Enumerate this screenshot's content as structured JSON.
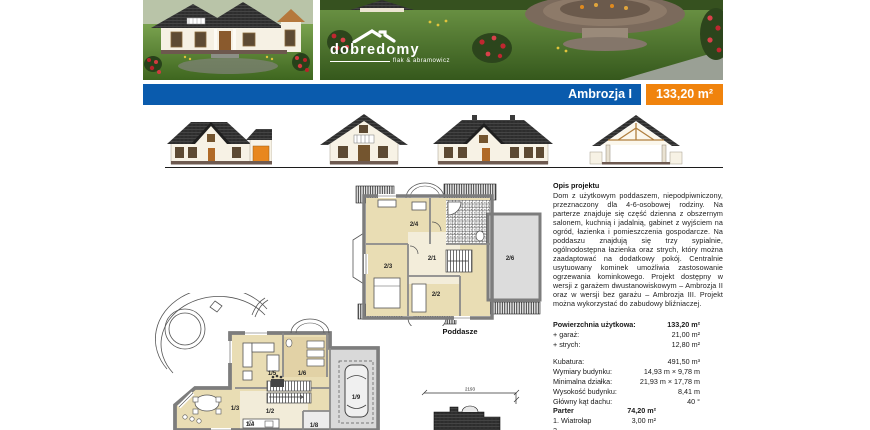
{
  "header": {
    "title": "Ambrozja I",
    "area_badge": "133,20 m²",
    "brand_name": "dobredomy",
    "brand_tagline": "flak & abramowicz"
  },
  "plans": {
    "attic": {
      "caption": "Poddasze",
      "rooms": [
        "2/1",
        "2/2",
        "2/3",
        "2/4",
        "2/6"
      ]
    },
    "ground": {
      "rooms": [
        "1/2",
        "1/3",
        "1/4",
        "1/5",
        "1/6",
        "1/8",
        "1/9"
      ]
    },
    "roof_outline": {
      "width_dimension": "2193"
    }
  },
  "description": {
    "heading": "Opis projektu",
    "body": "Dom z użytkowym poddaszem, niepodpiwniczony, przeznaczony dla 4-6-osobowej rodziny. Na parterze znajduje się część dzienna z obszernym salonem, kuchnią i jadalnią, gabinet z wyjściem na ogród, łazienka i pomieszczenia gospodarcze. Na poddaszu znajdują się trzy sypialnie, ogólnodostępna łazienka oraz strych, który można zaadaptować na dodatkowy pokój. Centralnie usytuowany kominek umożliwia zastosowanie ogrzewania kominkowego. Projekt dostępny w wersji z garażem dwustanowiskowym – Ambrozja II oraz w wersji bez garażu – Ambrozja III. Projekt można wykorzystać do zabudowy bliźniaczej."
  },
  "specs": {
    "main": [
      {
        "label": "Powierzchnia użytkowa:",
        "value": "133,20 m²"
      },
      {
        "label": "+ garaż:",
        "value": "21,00 m²"
      },
      {
        "label": "+ strych:",
        "value": "12,80 m²"
      }
    ],
    "details": [
      {
        "label": "Kubatura:",
        "value": "491,50 m³"
      },
      {
        "label": "Wymiary budynku:",
        "value": "14,93 m × 9,78 m"
      },
      {
        "label": "Minimalna działka:",
        "value": "21,93 m × 17,78 m"
      },
      {
        "label": "Wysokość budynku:",
        "value": "8,41 m"
      },
      {
        "label": "Główny kąt dachu:",
        "value": "40 °"
      }
    ],
    "floor": {
      "title": "Parter",
      "area": "74,20 m²",
      "rooms": [
        {
          "name": "1. Wiatrołap",
          "value": "3,00 m²"
        },
        {
          "name": "2.",
          "value": ""
        }
      ]
    }
  },
  "colors": {
    "banner-blue": "#0a5bad",
    "accent-orange": "#f0830d",
    "roof-dark": "#2d2d2d",
    "plan-beige": "#e9ddb4",
    "plan-gray": "#dcdcdc",
    "wall-gray": "#7d7d7d",
    "lawn-green": "#5d8a38"
  }
}
